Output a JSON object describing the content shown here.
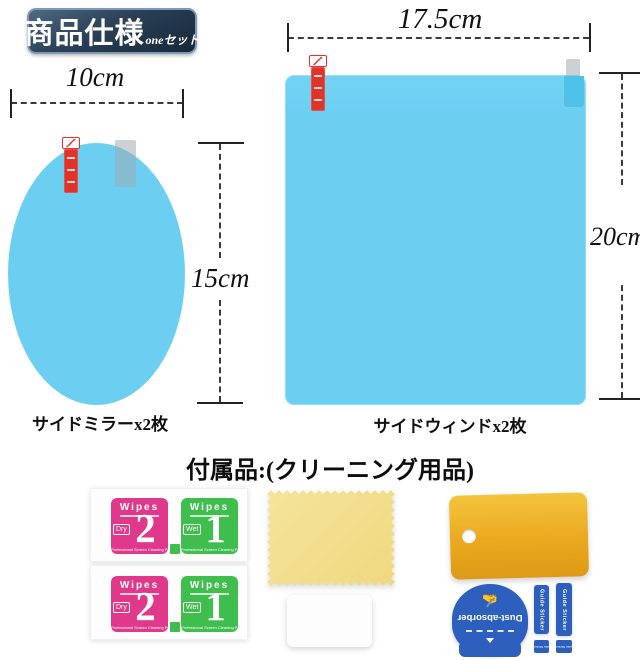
{
  "header": {
    "title": "商品仕様",
    "subtitle": "oneセット"
  },
  "films": {
    "mirror": {
      "width": "10cm",
      "height": "15cm",
      "caption": "サイドミラーx2枚"
    },
    "window": {
      "width": "17.5cm",
      "height": "20cm",
      "caption": "サイドウィンドx2枚"
    }
  },
  "accessories": {
    "heading": "付属品:(クリーニング用品)",
    "wipes": {
      "brand": "Wipes",
      "dry": {
        "label": "Dry",
        "number": "2"
      },
      "wet": {
        "label": "Wet",
        "number": "1"
      },
      "footer": "Professional Screen Cleaning Paper"
    },
    "sticker_sheet": {
      "dust_absorber": "Dust-absorber",
      "guide": "Guide Sticker"
    }
  },
  "colors": {
    "film_blue": "#6ccff2",
    "badge_navy": "#22364b",
    "peel_tab_red": "#e0342a",
    "wipes_pink": "#e0398b",
    "wipes_green": "#3fbe4e",
    "cloth_yellow": "#f2df90",
    "squeegee_yellow": "#eaa91f",
    "sticker_blue": "#2d60be"
  }
}
